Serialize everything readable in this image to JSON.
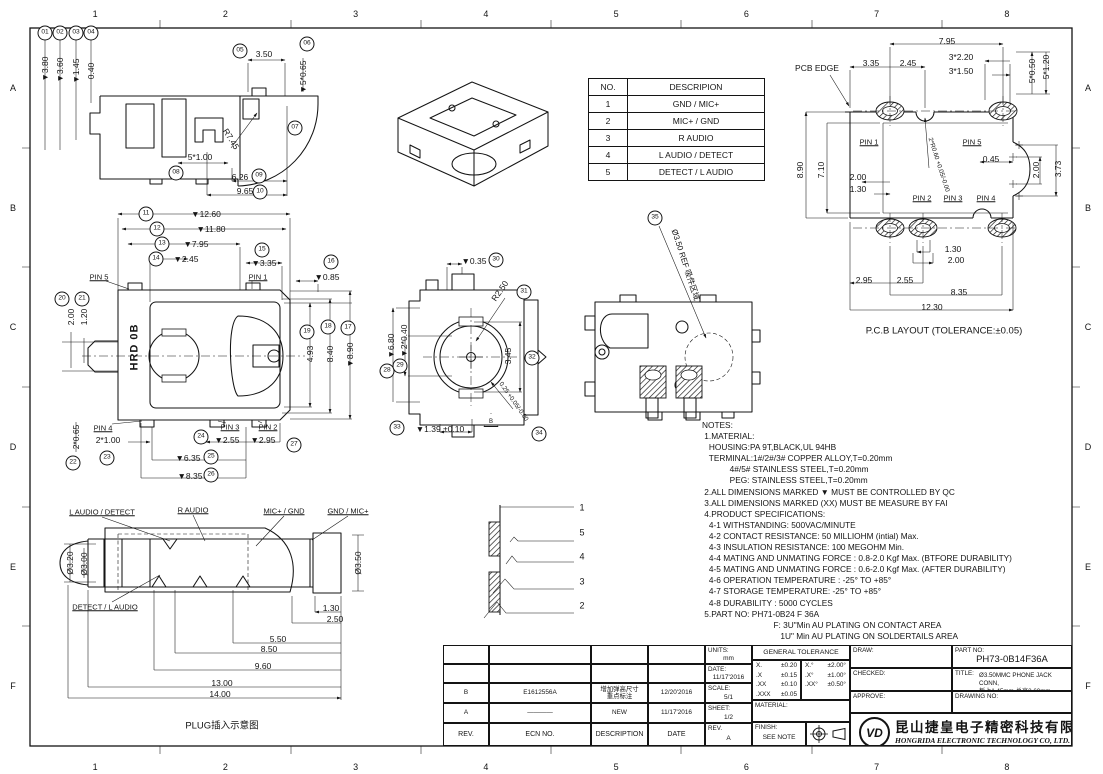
{
  "border": {
    "cols": [
      "1",
      "2",
      "3",
      "4",
      "5",
      "6",
      "7",
      "8"
    ],
    "rows": [
      "A",
      "B",
      "C",
      "D",
      "E",
      "F"
    ]
  },
  "signal_table": {
    "headers": [
      "NO.",
      "DESCRIPION"
    ],
    "rows": [
      [
        "1",
        "GND / MIC+"
      ],
      [
        "2",
        "MIC+ / GND"
      ],
      [
        "3",
        "R AUDIO"
      ],
      [
        "4",
        "L AUDIO / DETECT"
      ],
      [
        "5",
        "DETECT / L AUDIO"
      ]
    ]
  },
  "notes_lines": [
    "NOTES:",
    " 1.MATERIAL:",
    "   HOUSING:PA 9T,BLACK,UL 94HB",
    "   TERMINAL:1#/2#/3# COPPER ALLOY,T=0.20mm",
    "            4#/5# STAINLESS STEEL,T=0.20mm",
    "            PEG: STAINLESS STEEL,T=0.20mm",
    " 2.ALL DIMENSIONS MARKED ▼ MUST BE CONTROLLED BY QC",
    " 3.ALL DIMENSIONS MARKED (XX) MUST BE MEASURE BY FAI",
    " 4.PRODUCT SPECIFICATIONS:",
    "   4-1 WITHSTANDING: 500VAC/MINUTE",
    "   4-2 CONTACT RESISTANCE: 50 MILLIOHM (intial) Max.",
    "   4-3 INSULATION RESISTANCE: 100 MEGOHM Min.",
    "   4-4 MATING AND UNMATING FORCE : 0.8-2.0 Kgf Max. (BTFORE DURABILITY)",
    "   4-5 MATING AND UNMATING FORCE : 0.6-2.0 Kgf Max. (AFTER DURABILITY)",
    "   4-6 OPERATION TEMPERATURE : -25° TO +85°",
    "   4-7 STORAGE TEMPERATURE: -25° TO +85°",
    "   4-8 DURABILITY : 5000 CYCLES",
    " 5.PART NO: PH71-0B24 F 36A",
    "                               F: 3U\"Min AU PLATING ON CONTACT AREA",
    "                                  1U\" Min AU PLATING ON SOLDERTAILS AREA"
  ],
  "annotations": {
    "side_section": [
      {
        "b": "01",
        "x": 45,
        "y": 33
      },
      {
        "b": "02",
        "x": 60,
        "y": 33
      },
      {
        "b": "03",
        "x": 76,
        "y": 33
      },
      {
        "b": "04",
        "x": 91,
        "y": 33
      },
      {
        "t": "▼3.80",
        "x": 45,
        "y": 69,
        "r": -90
      },
      {
        "t": "▼3.60",
        "x": 60,
        "y": 70,
        "r": -90
      },
      {
        "t": "▼1.45",
        "x": 76,
        "y": 71,
        "r": -90
      },
      {
        "t": "0.40",
        "x": 91,
        "y": 71,
        "r": -90
      },
      {
        "b": "05",
        "x": 240,
        "y": 51
      },
      {
        "t": "3.50",
        "x": 264,
        "y": 54
      },
      {
        "b": "06",
        "x": 307,
        "y": 44
      },
      {
        "t": "▼5*0.65",
        "x": 303,
        "y": 77,
        "r": -90
      },
      {
        "t": "R7.45",
        "x": 231,
        "y": 139,
        "r": 58
      },
      {
        "b": "07",
        "x": 295,
        "y": 128
      },
      {
        "t": "5*1.00",
        "x": 200,
        "y": 157
      },
      {
        "b": "08",
        "x": 176,
        "y": 173
      },
      {
        "t": "6.26",
        "x": 240,
        "y": 177
      },
      {
        "b": "09",
        "x": 259,
        "y": 176
      },
      {
        "t": "9.65",
        "x": 245,
        "y": 191
      },
      {
        "b": "10",
        "x": 260,
        "y": 192
      }
    ],
    "top_view": [
      {
        "b": "11",
        "x": 146,
        "y": 214
      },
      {
        "t": "▼12.60",
        "x": 206,
        "y": 214
      },
      {
        "b": "12",
        "x": 157,
        "y": 229
      },
      {
        "t": "▼11.80",
        "x": 211,
        "y": 229
      },
      {
        "b": "13",
        "x": 162,
        "y": 244
      },
      {
        "t": "▼7.95",
        "x": 196,
        "y": 244
      },
      {
        "b": "14",
        "x": 156,
        "y": 259
      },
      {
        "t": "▼2.45",
        "x": 186,
        "y": 259
      },
      {
        "b": "15",
        "x": 262,
        "y": 250
      },
      {
        "t": "▼3.35",
        "x": 264,
        "y": 263
      },
      {
        "b": "16",
        "x": 331,
        "y": 262
      },
      {
        "t": "▼0.85",
        "x": 327,
        "y": 277
      },
      {
        "t": "PIN 5",
        "x": 99,
        "y": 277,
        "u": 1
      },
      {
        "t": "PIN 1",
        "x": 258,
        "y": 277,
        "u": 1
      },
      {
        "b": "20",
        "x": 62,
        "y": 299
      },
      {
        "b": "21",
        "x": 82,
        "y": 299
      },
      {
        "t": "2.00",
        "x": 71,
        "y": 317,
        "r": -90
      },
      {
        "t": "1.20",
        "x": 84,
        "y": 317,
        "r": -90
      },
      {
        "t": "HRD 0B",
        "x": 135,
        "y": 347,
        "r": -90,
        "cls": "brand"
      },
      {
        "b": "19",
        "x": 307,
        "y": 332
      },
      {
        "b": "18",
        "x": 328,
        "y": 327
      },
      {
        "b": "17",
        "x": 348,
        "y": 328
      },
      {
        "t": "4.93",
        "x": 310,
        "y": 354,
        "r": -90
      },
      {
        "t": "8.40",
        "x": 330,
        "y": 354,
        "r": -90
      },
      {
        "t": "▼8.90",
        "x": 350,
        "y": 355,
        "r": -90
      },
      {
        "t": "PIN 4",
        "x": 103,
        "y": 428,
        "u": 1
      },
      {
        "t": "PIN 3",
        "x": 230,
        "y": 427,
        "u": 1
      },
      {
        "t": "PIN 2",
        "x": 268,
        "y": 427,
        "u": 1
      },
      {
        "b": "22",
        "x": 73,
        "y": 463
      },
      {
        "t": "2*0.65",
        "x": 76,
        "y": 437,
        "r": -90
      },
      {
        "t": "2*1.00",
        "x": 108,
        "y": 440
      },
      {
        "b": "23",
        "x": 107,
        "y": 458
      },
      {
        "b": "24",
        "x": 201,
        "y": 437
      },
      {
        "t": "▼2.55",
        "x": 227,
        "y": 440
      },
      {
        "t": "▼2.95",
        "x": 263,
        "y": 440
      },
      {
        "b": "27",
        "x": 294,
        "y": 445
      },
      {
        "t": "▼6.35",
        "x": 188,
        "y": 458
      },
      {
        "b": "25",
        "x": 211,
        "y": 457
      },
      {
        "t": "▼8.35",
        "x": 190,
        "y": 476
      },
      {
        "b": "26",
        "x": 211,
        "y": 475
      }
    ],
    "front_view": [
      {
        "t": "▼0.35",
        "x": 474,
        "y": 261
      },
      {
        "b": "30",
        "x": 496,
        "y": 260
      },
      {
        "t": "R2.50",
        "x": 500,
        "y": 291,
        "r": -55
      },
      {
        "b": "31",
        "x": 524,
        "y": 292
      },
      {
        "t": "3.45",
        "x": 508,
        "y": 356,
        "r": -90
      },
      {
        "b": "32",
        "x": 532,
        "y": 358
      },
      {
        "t": "▼6.80",
        "x": 391,
        "y": 346,
        "r": -90
      },
      {
        "b": "28",
        "x": 387,
        "y": 371
      },
      {
        "t": "▼2*0.40",
        "x": 404,
        "y": 341,
        "r": -90
      },
      {
        "b": "29",
        "x": 400,
        "y": 366
      },
      {
        "b": "33",
        "x": 397,
        "y": 428
      },
      {
        "t": "▼1.39 ±0.10",
        "x": 440,
        "y": 429
      },
      {
        "t": "0.25 +0.05/-0.00",
        "x": 513,
        "y": 402,
        "r": 55,
        "fs": 6.3
      },
      {
        "tri": "B",
        "x": 491,
        "y": 420
      },
      {
        "b": "34",
        "x": 539,
        "y": 434
      }
    ],
    "bottom_view": [
      {
        "b": "35",
        "x": 655,
        "y": 218
      },
      {
        "t": "Ø3.50 REF 吸件区域",
        "x": 685,
        "y": 265,
        "r": 72,
        "fs": 8
      }
    ],
    "schematic": [
      {
        "t": "1",
        "x": 582,
        "y": 508,
        "fs": 9
      },
      {
        "t": "5",
        "x": 582,
        "y": 533,
        "fs": 9
      },
      {
        "t": "4",
        "x": 582,
        "y": 557,
        "fs": 9
      },
      {
        "t": "3",
        "x": 582,
        "y": 582,
        "fs": 9
      },
      {
        "t": "2",
        "x": 582,
        "y": 606,
        "fs": 9
      }
    ],
    "pcb_layout": [
      {
        "t": "7.95",
        "x": 947,
        "y": 41
      },
      {
        "t": "PCB EDGE",
        "x": 817,
        "y": 68
      },
      {
        "t": "3.35",
        "x": 871,
        "y": 63
      },
      {
        "t": "2.45",
        "x": 908,
        "y": 63
      },
      {
        "t": "3*2.20",
        "x": 961,
        "y": 57
      },
      {
        "t": "3*1.50",
        "x": 961,
        "y": 71
      },
      {
        "t": "5*0.50",
        "x": 1032,
        "y": 71,
        "r": -90
      },
      {
        "t": "5*1.20",
        "x": 1046,
        "y": 67,
        "r": -90
      },
      {
        "t": "8.90",
        "x": 800,
        "y": 170,
        "r": -90
      },
      {
        "t": "7.10",
        "x": 821,
        "y": 170,
        "r": -90
      },
      {
        "t": "PIN 1",
        "x": 869,
        "y": 142,
        "u": 1
      },
      {
        "t": "PIN 5",
        "x": 972,
        "y": 142,
        "u": 1
      },
      {
        "t": "2*R0.60 +0.05/-0.00",
        "x": 938,
        "y": 165,
        "r": 72,
        "fs": 6.3
      },
      {
        "t": "0.45",
        "x": 991,
        "y": 159
      },
      {
        "t": "2.00",
        "x": 1036,
        "y": 170,
        "r": -90
      },
      {
        "t": "3.73",
        "x": 1058,
        "y": 169,
        "r": -90
      },
      {
        "t": "2.00",
        "x": 858,
        "y": 177
      },
      {
        "t": "1.30",
        "x": 858,
        "y": 189
      },
      {
        "t": "PIN 2",
        "x": 922,
        "y": 198,
        "u": 1
      },
      {
        "t": "PIN 3",
        "x": 953,
        "y": 198,
        "u": 1
      },
      {
        "t": "PIN 4",
        "x": 986,
        "y": 198,
        "u": 1
      },
      {
        "t": "1.30",
        "x": 953,
        "y": 249
      },
      {
        "t": "2.00",
        "x": 956,
        "y": 260
      },
      {
        "t": "2.95",
        "x": 864,
        "y": 280
      },
      {
        "t": "2.55",
        "x": 905,
        "y": 280
      },
      {
        "t": "8.35",
        "x": 959,
        "y": 292
      },
      {
        "t": "12.30",
        "x": 932,
        "y": 307
      },
      {
        "t": "P.C.B LAYOUT (TOLERANCE:±0.05)",
        "x": 944,
        "y": 331,
        "cls": "cap"
      }
    ],
    "plug_view": [
      {
        "t": "L AUDIO / DETECT",
        "x": 102,
        "y": 512,
        "u": 1
      },
      {
        "t": "R AUDIO",
        "x": 193,
        "y": 510,
        "u": 1
      },
      {
        "t": "MIC+ / GND",
        "x": 284,
        "y": 511,
        "u": 1
      },
      {
        "t": "GND / MIC+",
        "x": 348,
        "y": 511,
        "u": 1
      },
      {
        "t": "DETECT / L AUDIO",
        "x": 105,
        "y": 607,
        "u": 1
      },
      {
        "t": "Ø3.20",
        "x": 70,
        "y": 563,
        "r": -90
      },
      {
        "t": "Ø3.00",
        "x": 84,
        "y": 564,
        "r": -90
      },
      {
        "t": "Ø3.50",
        "x": 358,
        "y": 563,
        "r": -90
      },
      {
        "t": "1.30",
        "x": 331,
        "y": 608
      },
      {
        "t": "2.50",
        "x": 335,
        "y": 619
      },
      {
        "t": "5.50",
        "x": 278,
        "y": 639
      },
      {
        "t": "8.50",
        "x": 269,
        "y": 649
      },
      {
        "t": "9.60",
        "x": 263,
        "y": 666
      },
      {
        "t": "13.00",
        "x": 222,
        "y": 683
      },
      {
        "t": "14.00",
        "x": 220,
        "y": 694
      },
      {
        "t": "PLUG插入示意图",
        "x": 222,
        "y": 726,
        "cls": "cap"
      }
    ]
  },
  "titleblock": {
    "rev_table": {
      "headers": [
        "REV.",
        "ECN NO.",
        "DESCRIPTION",
        "DATE"
      ],
      "rows": [
        {
          "rev": "B",
          "ecn": "E1612556A",
          "desc": "增加弹高尺寸\n重点标注",
          "date": "12/20'2016"
        },
        {
          "rev": "A",
          "ecn": "————",
          "desc": "NEW",
          "date": "11/17'2016"
        }
      ]
    },
    "info": {
      "units_label": "UNITS:",
      "units": "mm",
      "date_label": "DATE:",
      "date": "11/17'2016",
      "scale_label": "SCALE:",
      "scale": "5/1",
      "sheet_label": "SHEET:",
      "sheet": "1/2",
      "rev_label": "REV.",
      "rev": "A"
    },
    "tolerance": {
      "title": "GENERAL TOLERANCE",
      "linear": [
        [
          "X.",
          "±0.20"
        ],
        [
          ".X",
          "±0.15"
        ],
        [
          ".XX",
          "±0.10"
        ],
        [
          ".XXX",
          "±0.05"
        ]
      ],
      "angular": [
        [
          "X.°",
          "±2.00°"
        ],
        [
          ".X°",
          "±1.00°"
        ],
        [
          ".XX°",
          "±0.50°"
        ]
      ]
    },
    "material_label": "MATERIAL:",
    "finish_label": "FINISH:",
    "finish": "SEE NOTE",
    "draw_label": "DRAW:",
    "checked_label": "CHECKED:",
    "approve_label": "APPROVE:",
    "partno_label": "PART NO:",
    "partno": "PH73-0B14F36A",
    "title_label": "TITLE:",
    "title_line1": "Ø3.50MMC PHONE JACK CONN,",
    "title_line2": "板上1.45mm·总高3.60mm",
    "drawingno_label": "DRAWING NO:",
    "company": {
      "logo": "VD",
      "cn": "昆山捷皇电子精密科技有限公司",
      "en": "HONGRIDA ELECTRONIC TECHNOLOGY CO, LTD."
    }
  }
}
